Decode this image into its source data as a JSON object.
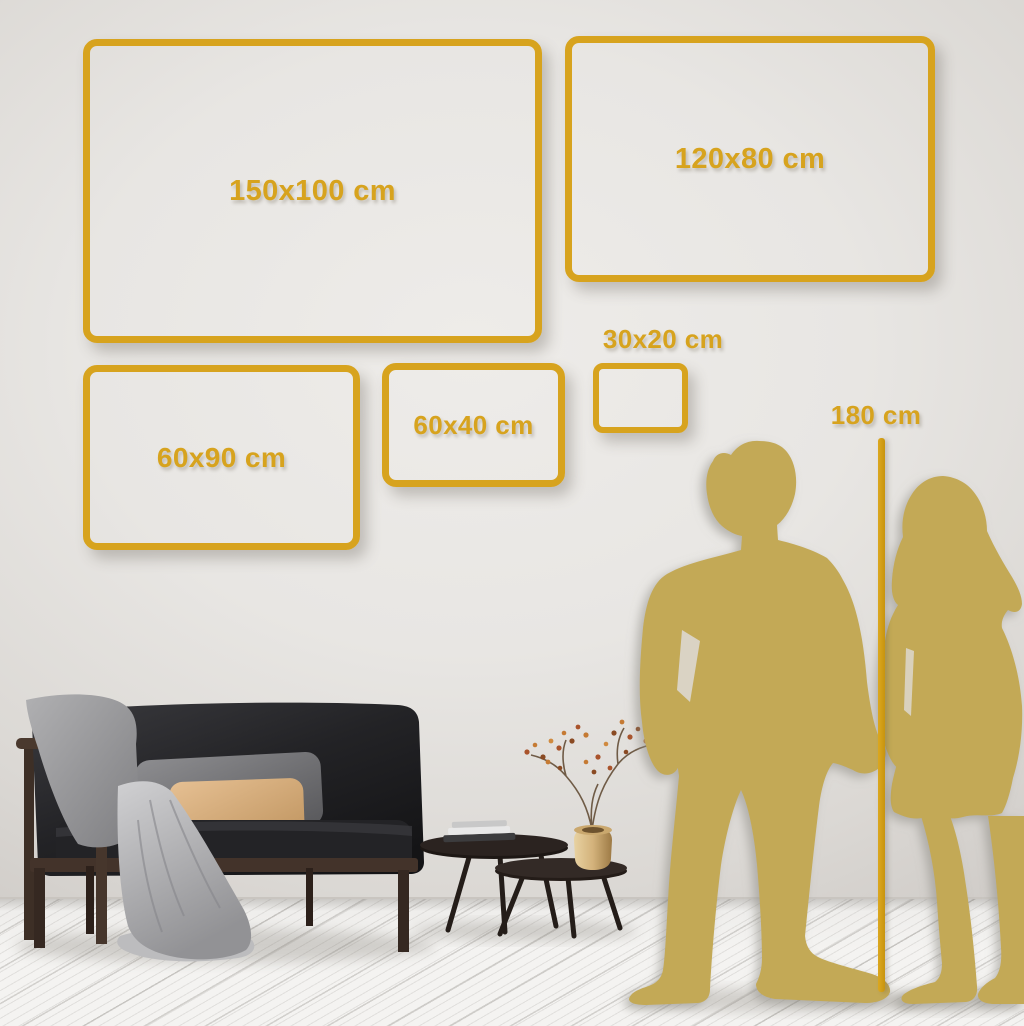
{
  "size_guide": {
    "frames": [
      {
        "label": "150x100 cm"
      },
      {
        "label": "120x80 cm"
      },
      {
        "label": "60x90 cm"
      },
      {
        "label": "60x40 cm"
      },
      {
        "label": "30x20 cm"
      }
    ],
    "person_height": {
      "label": "180 cm"
    }
  },
  "palette": {
    "accent_gold": "#d7a31e",
    "silhouette_gold": "#c3a956",
    "wall_gray": "#e7e5e2",
    "floor_white": "#f2f1ef",
    "sofa_charcoal": "#1f1f22",
    "pillow_tan": "#d8b183",
    "vase_brass": "#cfae74"
  },
  "scene": {
    "elements": [
      "wall",
      "wood-floor",
      "couple-silhouette",
      "height-line",
      "sofa",
      "throw-blanket",
      "pillows",
      "coffee-tables",
      "books",
      "brass-vase",
      "dried-plant"
    ]
  }
}
